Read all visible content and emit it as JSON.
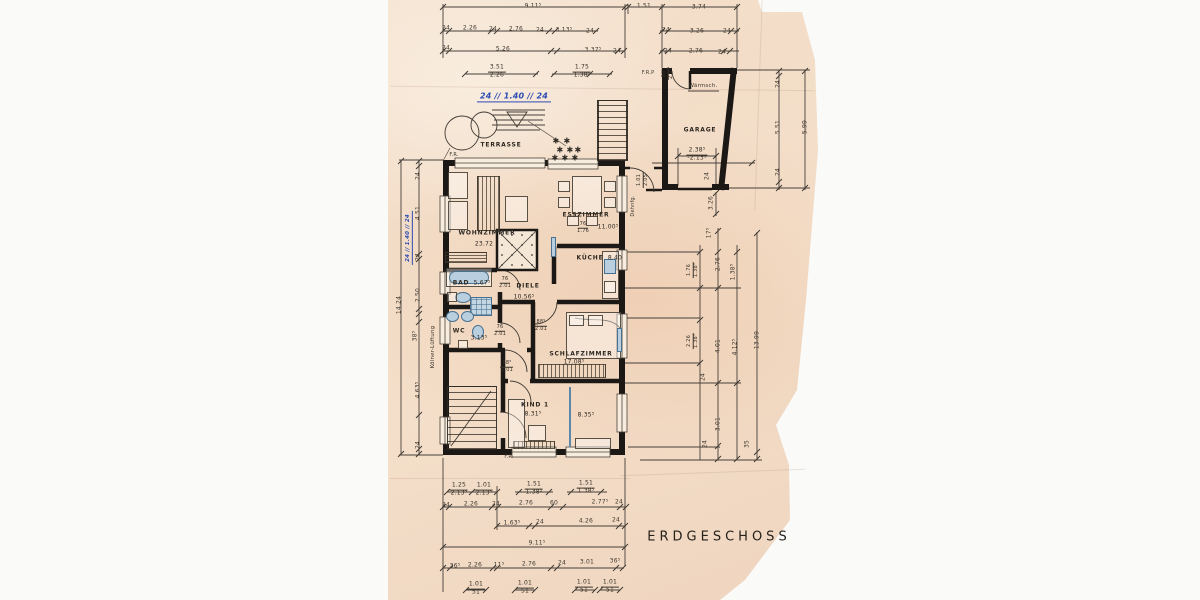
{
  "title": "ERDGESCHOSS",
  "colors": {
    "paper": "#f3ddc8",
    "ink": "#352f27",
    "wall": "#191613",
    "fixture_blue": "#b9cfdf",
    "handwriting_blue": "#2b4bb3"
  },
  "rooms": [
    {
      "label": "TERRASSE",
      "area": ""
    },
    {
      "label": "WOHNZIMMER",
      "area": "23.72"
    },
    {
      "label": "ESSZIMMER",
      "area": "11.00⁵"
    },
    {
      "label": "KÜCHE",
      "area": "8.40"
    },
    {
      "label": "BAD",
      "area": "5.67⁵"
    },
    {
      "label": "DIELE",
      "area": "10.56⁵"
    },
    {
      "label": "WC",
      "area": "3.13⁵"
    },
    {
      "label": "SCHLAFZIMMER",
      "area": "17.08⁵"
    },
    {
      "label": "KIND 1",
      "area": "8.31⁵"
    },
    {
      "label": "",
      "area": "8.35⁵"
    },
    {
      "label": "GARAGE",
      "area": ""
    }
  ],
  "plan": {
    "labels": [
      {
        "t": "9.11⁵",
        "x": 533,
        "y": 7
      },
      {
        "t": "1.51",
        "x": 644,
        "y": 7
      },
      {
        "t": "3.74",
        "x": 699,
        "y": 8
      },
      {
        "t": "24",
        "x": 446,
        "y": 29
      },
      {
        "t": "2.26",
        "x": 470,
        "y": 29
      },
      {
        "t": "24",
        "x": 493,
        "y": 30
      },
      {
        "t": "2.76",
        "x": 516,
        "y": 30
      },
      {
        "t": "24",
        "x": 540,
        "y": 31
      },
      {
        "t": "3.13⁵",
        "x": 564,
        "y": 31
      },
      {
        "t": "24",
        "x": 590,
        "y": 32
      },
      {
        "t": "24",
        "x": 666,
        "y": 31
      },
      {
        "t": "3.26",
        "x": 697,
        "y": 32
      },
      {
        "t": "24",
        "x": 727,
        "y": 32
      },
      {
        "t": "24",
        "x": 446,
        "y": 49
      },
      {
        "t": "5.26",
        "x": 503,
        "y": 50
      },
      {
        "t": "3.37⁵",
        "x": 593,
        "y": 51
      },
      {
        "t": "24",
        "x": 617,
        "y": 52
      },
      {
        "t": "24",
        "x": 668,
        "y": 52
      },
      {
        "t": "2.76",
        "x": 696,
        "y": 52
      },
      {
        "t": "24",
        "x": 722,
        "y": 53
      },
      {
        "c": "pair",
        "t": "3.51|2.26",
        "x": 497,
        "y": 72
      },
      {
        "c": "pair",
        "t": "1.75|1.38⁵",
        "x": 582,
        "y": 72
      },
      {
        "c": "hand",
        "n": "handwritten-note-top",
        "t": "24 ∕∕ 1.40 ∕∕ 24",
        "x": 514,
        "y": 97,
        "s": 8
      },
      {
        "n": "note-frp",
        "t": "F.R.P",
        "x": 648,
        "y": 74,
        "s": 5
      },
      {
        "c": "pair",
        "t": "88⁵|2.01",
        "x": 668,
        "y": 73,
        "r": -90,
        "s": 5
      },
      {
        "n": "note-waermsch",
        "t": "Wärmsch.",
        "x": 703,
        "y": 86,
        "s": 5.5
      },
      {
        "n": "room-label-garage",
        "c": "room",
        "t": "GARAGE",
        "x": 700,
        "y": 131
      },
      {
        "c": "pair",
        "t": "2.38⁵|-2.13⁵",
        "x": 697,
        "y": 155
      },
      {
        "t": "24",
        "x": 708,
        "y": 176,
        "r": -90
      },
      {
        "t": "3.26",
        "x": 712,
        "y": 203,
        "r": -90
      },
      {
        "t": "24",
        "x": 779,
        "y": 84,
        "r": -90
      },
      {
        "t": "5.51",
        "x": 779,
        "y": 127,
        "r": -90
      },
      {
        "t": "24",
        "x": 779,
        "y": 172,
        "r": -90
      },
      {
        "t": "5.99",
        "x": 806,
        "y": 127,
        "r": -90
      },
      {
        "n": "note-fr-top",
        "t": "F.R.",
        "x": 454,
        "y": 156,
        "s": 5
      },
      {
        "n": "room-label-terrasse",
        "c": "room",
        "t": "TERRASSE",
        "x": 501,
        "y": 146
      },
      {
        "n": "note-dehnfuge",
        "t": "Dehnfg.",
        "x": 634,
        "y": 206,
        "r": -90,
        "s": 5
      },
      {
        "c": "pair",
        "t": "1.01|2.05",
        "x": 643,
        "y": 180,
        "r": -90,
        "s": 5
      },
      {
        "n": "room-label-esszimmer",
        "c": "room",
        "t": "ESSZIMMER",
        "x": 586,
        "y": 216
      },
      {
        "c": "pair",
        "t": "76|1.76",
        "x": 583,
        "y": 228,
        "s": 5
      },
      {
        "c": "area",
        "t": "11.00⁵",
        "x": 608,
        "y": 228
      },
      {
        "n": "room-label-wohnzimmer",
        "c": "room",
        "t": "WOHNZIMMER",
        "x": 487,
        "y": 234
      },
      {
        "c": "area",
        "t": "23.72",
        "x": 484,
        "y": 245
      },
      {
        "n": "room-label-kueche",
        "c": "room",
        "t": "KÜCHE",
        "x": 590,
        "y": 259
      },
      {
        "c": "area",
        "t": "8.40",
        "x": 615,
        "y": 259
      },
      {
        "n": "room-label-bad",
        "c": "room",
        "t": "BAD",
        "x": 461,
        "y": 284
      },
      {
        "c": "area",
        "t": "5.67⁵",
        "x": 482,
        "y": 284
      },
      {
        "c": "pair",
        "t": "76|2.01",
        "x": 505,
        "y": 283,
        "s": 5
      },
      {
        "n": "room-label-diele",
        "c": "room",
        "t": "DIELE",
        "x": 528,
        "y": 287
      },
      {
        "c": "area",
        "t": "10.56⁵",
        "x": 524,
        "y": 298
      },
      {
        "n": "room-label-wc",
        "c": "room",
        "t": "WC",
        "x": 459,
        "y": 332
      },
      {
        "c": "area",
        "t": "3.13⁵",
        "x": 479,
        "y": 339
      },
      {
        "c": "pair",
        "t": "76|2.01",
        "x": 500,
        "y": 331,
        "s": 5
      },
      {
        "c": "pair",
        "t": "88⁵|2.01",
        "x": 541,
        "y": 326,
        "s": 5
      },
      {
        "c": "pair",
        "t": "88⁵|2.01",
        "x": 507,
        "y": 367,
        "s": 5
      },
      {
        "n": "room-label-schlafzimmer",
        "c": "room",
        "t": "SCHLAFZIMMER",
        "x": 581,
        "y": 355
      },
      {
        "c": "area",
        "t": "17.08⁵",
        "x": 574,
        "y": 363
      },
      {
        "n": "room-label-kind1",
        "c": "room",
        "t": "KIND 1",
        "x": 535,
        "y": 406
      },
      {
        "c": "area",
        "t": "8.31⁵",
        "x": 533,
        "y": 415
      },
      {
        "c": "area",
        "t": "8.35⁵",
        "x": 586,
        "y": 416
      },
      {
        "n": "note-fr-bottom",
        "t": "F.R.",
        "x": 509,
        "y": 458,
        "s": 5
      },
      {
        "t": "14.24",
        "x": 400,
        "y": 305,
        "r": -90
      },
      {
        "t": "24",
        "x": 419,
        "y": 176,
        "r": -90
      },
      {
        "t": "4.51",
        "x": 419,
        "y": 213,
        "r": -90
      },
      {
        "c": "hand",
        "n": "handwritten-note-left",
        "t": "24 ∕∕ 1.40 ∕∕ 24",
        "x": 409,
        "y": 238,
        "r": -90,
        "s": 5.5
      },
      {
        "t": "24",
        "x": 419,
        "y": 257,
        "r": -90
      },
      {
        "t": "2.50",
        "x": 419,
        "y": 295,
        "r": -90
      },
      {
        "t": "38⁵",
        "x": 416,
        "y": 336,
        "r": -90
      },
      {
        "t": "4.63⁵",
        "x": 419,
        "y": 390,
        "r": -90
      },
      {
        "t": "24",
        "x": 419,
        "y": 445,
        "r": -90
      },
      {
        "n": "note-koelner-lueftung",
        "t": "Kölner-Lüftung",
        "x": 433,
        "y": 347,
        "r": -90,
        "s": 5.5
      },
      {
        "t": "17⁵",
        "x": 710,
        "y": 233,
        "r": -90
      },
      {
        "c": "pair",
        "t": "1.76|1.38⁵",
        "x": 693,
        "y": 270,
        "r": -90,
        "s": 5
      },
      {
        "t": "2.76",
        "x": 719,
        "y": 264,
        "r": -90
      },
      {
        "t": "1.38⁵",
        "x": 734,
        "y": 272,
        "r": -90
      },
      {
        "c": "pair",
        "t": "2.26|1.38⁵",
        "x": 693,
        "y": 341,
        "r": -90,
        "s": 5
      },
      {
        "t": "4.01",
        "x": 719,
        "y": 346,
        "r": -90
      },
      {
        "t": "4.12⁵",
        "x": 736,
        "y": 347,
        "r": -90
      },
      {
        "t": "13.99",
        "x": 758,
        "y": 340,
        "r": -90
      },
      {
        "t": "24",
        "x": 704,
        "y": 377,
        "r": -90
      },
      {
        "t": "3.01",
        "x": 719,
        "y": 424,
        "r": -90
      },
      {
        "t": "24",
        "x": 706,
        "y": 444,
        "r": -90
      },
      {
        "t": "35",
        "x": 748,
        "y": 444,
        "r": -90
      },
      {
        "c": "pair",
        "t": "1.25|2.13⁵",
        "x": 459,
        "y": 490
      },
      {
        "c": "pair",
        "t": "1.01|2.13⁵",
        "x": 484,
        "y": 490
      },
      {
        "c": "pair",
        "t": "1.51|1.38⁵",
        "x": 534,
        "y": 489
      },
      {
        "c": "pair",
        "t": "1.51|1.38⁵",
        "x": 586,
        "y": 488
      },
      {
        "t": "24",
        "x": 446,
        "y": 506
      },
      {
        "t": "2.26",
        "x": 471,
        "y": 505
      },
      {
        "t": "24",
        "x": 496,
        "y": 505
      },
      {
        "t": "2.76",
        "x": 526,
        "y": 504
      },
      {
        "t": "60",
        "x": 554,
        "y": 504
      },
      {
        "t": "2.77⁵",
        "x": 600,
        "y": 503
      },
      {
        "t": "24",
        "x": 619,
        "y": 503
      },
      {
        "t": "1.63⁵",
        "x": 512,
        "y": 524
      },
      {
        "t": "24",
        "x": 540,
        "y": 523
      },
      {
        "t": "4.26",
        "x": 586,
        "y": 522
      },
      {
        "t": "24",
        "x": 616,
        "y": 521
      },
      {
        "t": "9.11⁵",
        "x": 537,
        "y": 544
      },
      {
        "t": "36⁵",
        "x": 455,
        "y": 567
      },
      {
        "t": "2.26",
        "x": 475,
        "y": 566
      },
      {
        "t": "11⁵",
        "x": 499,
        "y": 566
      },
      {
        "t": "2.76",
        "x": 529,
        "y": 565
      },
      {
        "t": "24",
        "x": 562,
        "y": 564
      },
      {
        "t": "3.01",
        "x": 587,
        "y": 563
      },
      {
        "t": "36⁵",
        "x": 615,
        "y": 562
      },
      {
        "c": "pair",
        "t": "1.01|51",
        "x": 476,
        "y": 589
      },
      {
        "c": "pair",
        "t": "1.01|51",
        "x": 525,
        "y": 588
      },
      {
        "c": "pair",
        "t": "1.01|51",
        "x": 584,
        "y": 587
      },
      {
        "c": "pair",
        "t": "1.01|51",
        "x": 610,
        "y": 587
      },
      {
        "n": "plant-icon",
        "c": "plant",
        "t": "✱",
        "x": 556,
        "y": 141,
        "s": 8
      },
      {
        "n": "plant-icon",
        "c": "plant",
        "t": "✱",
        "x": 567,
        "y": 141,
        "s": 8
      },
      {
        "n": "plant-icon",
        "c": "plant",
        "t": "✱",
        "x": 560,
        "y": 150,
        "s": 8
      },
      {
        "n": "plant-icon",
        "c": "plant",
        "t": "✱",
        "x": 570,
        "y": 150,
        "s": 8
      },
      {
        "n": "plant-icon",
        "c": "plant",
        "t": "✱",
        "x": 578,
        "y": 150,
        "s": 8
      },
      {
        "n": "plant-icon",
        "c": "plant",
        "t": "✱",
        "x": 555,
        "y": 158,
        "s": 8
      },
      {
        "n": "plant-icon",
        "c": "plant",
        "t": "✱",
        "x": 565,
        "y": 158,
        "s": 8
      },
      {
        "n": "plant-icon",
        "c": "plant",
        "t": "✱",
        "x": 575,
        "y": 158,
        "s": 8
      }
    ]
  }
}
